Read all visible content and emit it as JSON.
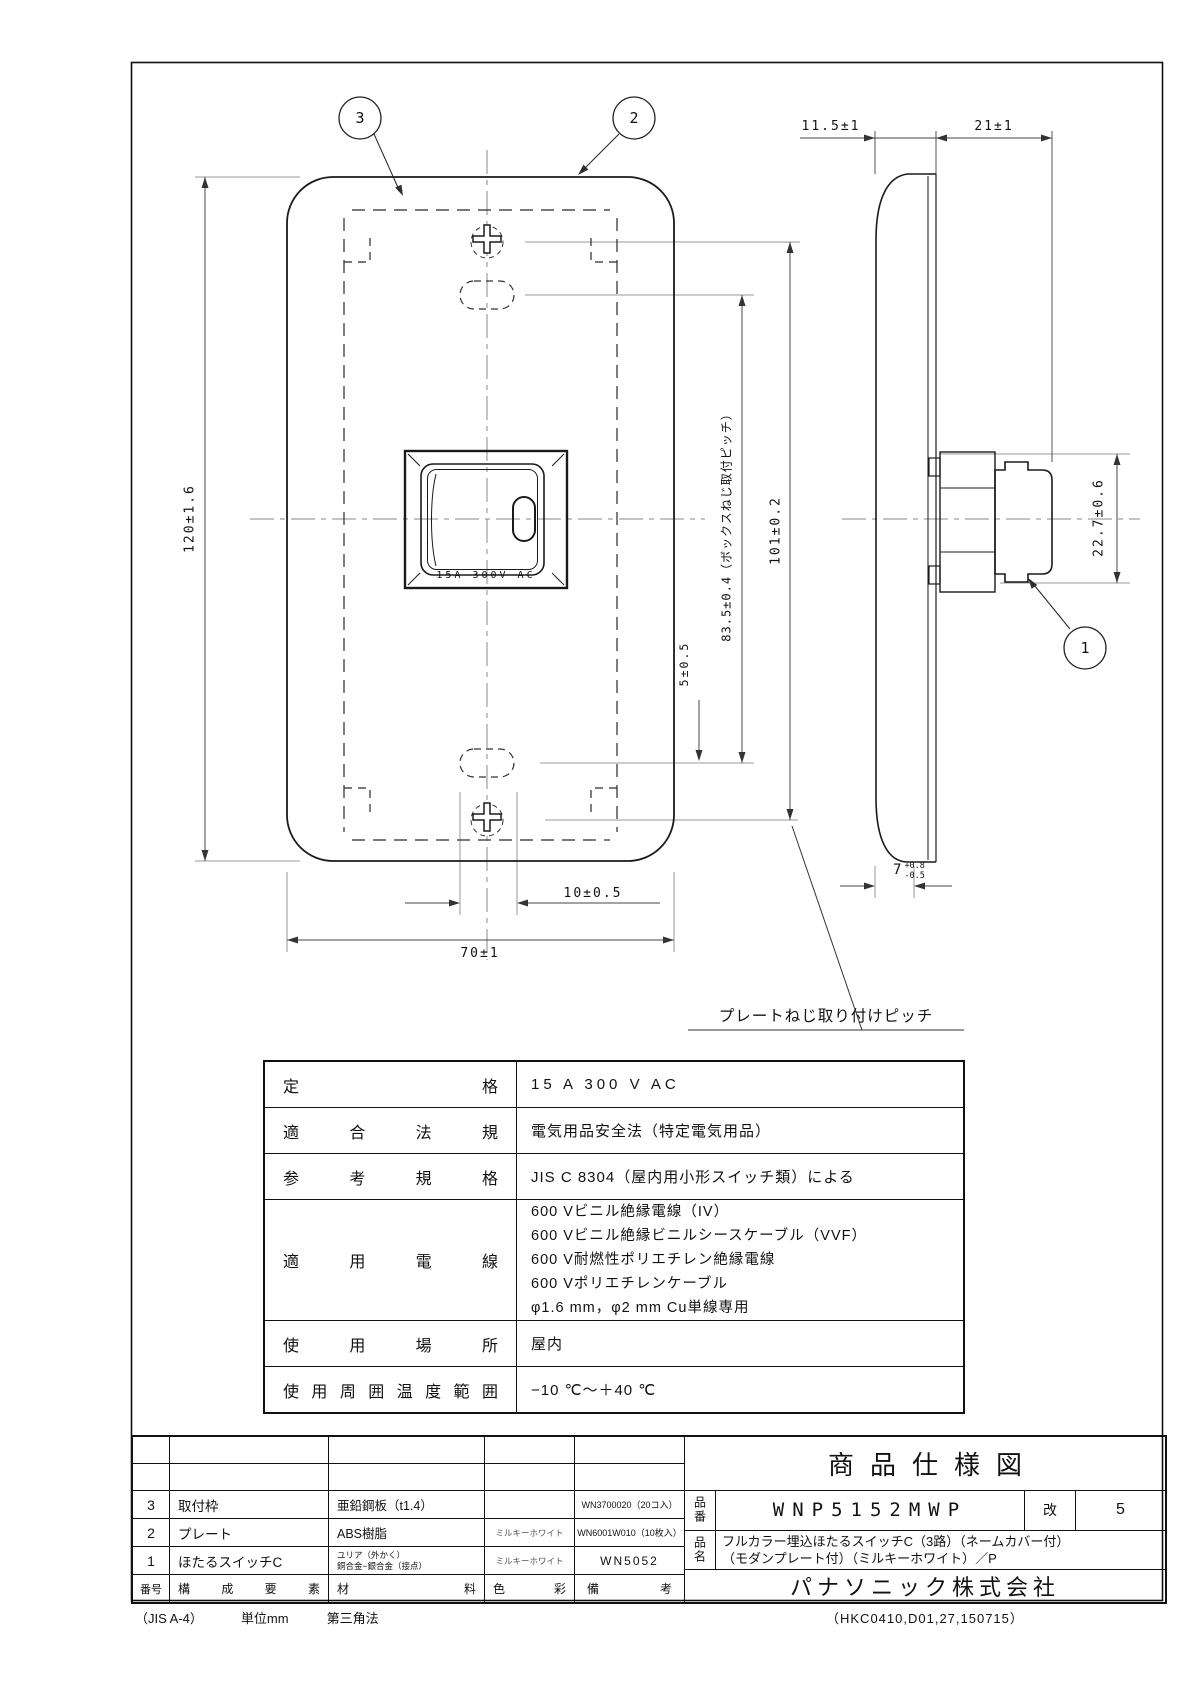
{
  "drawing": {
    "balloons": {
      "plate_frame": "3",
      "plate": "2",
      "switch_body": "1"
    },
    "front_view": {
      "switch_label": "15A 300V AC",
      "dim_height": "120±1.6",
      "dim_width": "70±1",
      "dim_slot_width": "10±0.5",
      "dim_box_screw_pitch": "83.5±0.4（ボックスねじ取付ピッチ）",
      "dim_plate_screw_pitch": "101±0.2",
      "dim_slot_offset": "5±0.5",
      "plate_screw_note": "プレートねじ取り付けピッチ"
    },
    "side_view": {
      "dim_plate_thickness": "11.5±1",
      "dim_box_depth": "21±1",
      "dim_body_height": "22.7±0.6",
      "dim_protrusion": "7",
      "dim_protrusion_plus": "+0.8",
      "dim_protrusion_minus": "-0.5"
    }
  },
  "spec_table": {
    "rows": [
      {
        "label": "定格",
        "values": [
          "15 A 300 V AC"
        ]
      },
      {
        "label": "適合法規",
        "values": [
          "電気用品安全法（特定電気用品）"
        ]
      },
      {
        "label": "参考規格",
        "values": [
          "JIS C 8304（屋内用小形スイッチ類）による"
        ]
      },
      {
        "label": "適用電線",
        "values": [
          "600 Vビニル絶縁電線（IV）",
          "600 Vビニル絶縁ビニルシースケーブル（VVF）",
          "600 V耐燃性ポリエチレン絶縁電線",
          "600 Vポリエチレンケーブル",
          "φ1.6 mm，φ2 mm Cu単線専用"
        ]
      },
      {
        "label": "使用場所",
        "values": [
          "屋内"
        ]
      },
      {
        "label": "使用周囲温度範囲",
        "values": [
          "−10 ℃〜＋40 ℃"
        ]
      }
    ]
  },
  "parts_table": {
    "header": {
      "no": "番号",
      "name": "構成要素",
      "material": "材料",
      "color": "色彩",
      "note": "備考"
    },
    "rows": [
      {
        "no": "3",
        "name": "取付枠",
        "material": "亜鉛鋼板（t1.4）",
        "color": "",
        "note": "WN3700020（20コ入）"
      },
      {
        "no": "2",
        "name": "プレート",
        "material": "ABS樹脂",
        "color": "ミルキーホワイト",
        "note": "WN6001W010（10枚入）"
      },
      {
        "no": "1",
        "name": "ほたるスイッチC",
        "material_line1": "ユリア（外かく）",
        "material_line2": "銅合金−銀合金（接点）",
        "color": "ミルキーホワイト",
        "note": "WN5052"
      }
    ]
  },
  "title_block": {
    "title": "商品仕様図",
    "part_no_label": "品番",
    "part_no": "WNP5152MWP",
    "rev_label": "改",
    "rev": "5",
    "name_label": "品名",
    "name_line1": "フルカラー埋込ほたるスイッチC（3路）（ネームカバー付）",
    "name_line2": "（モダンプレート付）（ミルキーホワイト）／P",
    "company": "パナソニック株式会社"
  },
  "footer": {
    "sheet": "（JIS A-4）",
    "unit": "単位mm",
    "projection": "第三角法",
    "doc_no": "（HKC0410,D01,27,150715）"
  }
}
